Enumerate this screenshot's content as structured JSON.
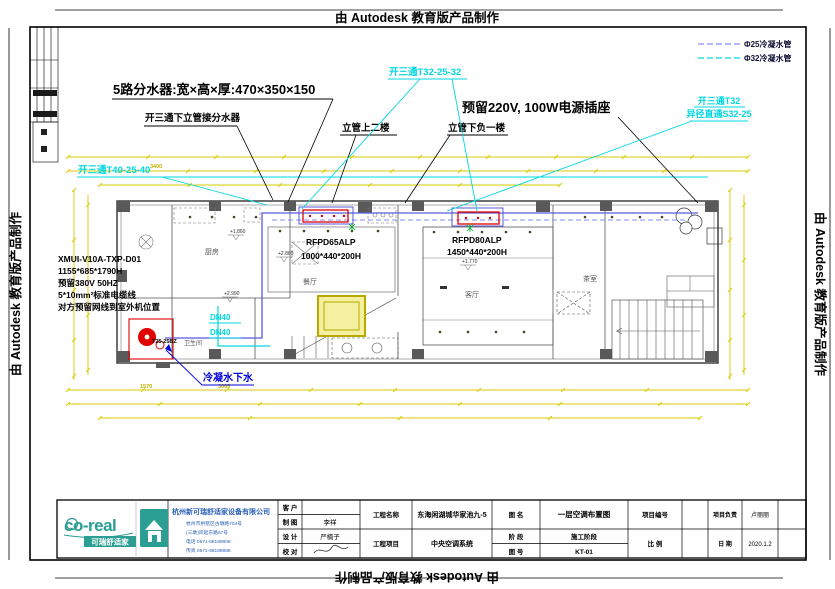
{
  "watermark": {
    "text": "由 Autodesk 教育版产品制作"
  },
  "legend": {
    "items": [
      {
        "label": "Φ25冷凝水管",
        "color": "#8a8af5"
      },
      {
        "label": "Φ32冷凝水管",
        "color": "#00d7e0"
      }
    ]
  },
  "callouts": {
    "manifold": "5路分水器:宽×高×厚:470×350×150",
    "tee_branch": "开三通下立管接分水器",
    "riser_up": "立管上二楼",
    "riser_down": "立管下负一楼",
    "power_socket": "预留220V, 100W电源插座",
    "tee_t32": "开三通T32-25-32",
    "tee_t32_right_line1": "开三通T32",
    "tee_t32_right_line2": "异径直通S32-25",
    "tee_t40": "开三通T40-25-40",
    "condensate_drain": "冷凝水下水",
    "dn40_a": "DN40",
    "dn40_b": "DN40",
    "pipe_tag": "T25-25BZ"
  },
  "outdoor_unit_note": {
    "lines": [
      "XMUI-V10A-TXP-D01",
      "1155*685*1790H",
      "预留380V 50HZ",
      "5*10mm²标准电缆线",
      "对方预留网线到室外机位置"
    ]
  },
  "indoor_units": {
    "unit1": {
      "model": "RFPD65ALP",
      "size": "1000*440*200H"
    },
    "unit2": {
      "model": "RFPD80ALP",
      "size": "1450*440*200H"
    }
  },
  "rooms": {
    "kitchen": "厨房",
    "dining": "餐厅",
    "living": "客厅",
    "tea": "茶室",
    "bath": "卫生间"
  },
  "levels": {
    "e1": "+1.860",
    "e2": "+2.860",
    "e3": "+1.770",
    "e4": "+2.990"
  },
  "dimensions": {
    "top_1": "3400",
    "bottom_1": "1570",
    "bottom_2": "3065"
  },
  "titleblock": {
    "logo_text": "co-real",
    "logo_sub": "可瑞舒适家",
    "company": "杭州新可瑞舒适家设备有限公司",
    "company_lines": [
      "杭州市拱墅区古墩路704号",
      "(三墩)风起东路67号",
      "电话 0571-88188808",
      "传真 0571-88188888"
    ],
    "fields": {
      "client_label": "客 户",
      "draft_label": "制 图",
      "draft_value": "李祥",
      "design_label": "设 计",
      "design_value": "严楠子",
      "check_label": "校 对",
      "project_name_label": "工程名称",
      "project_name_value": "东海闲湖城华家池九-5",
      "project_item_label": "工程项目",
      "project_item_value": "中央空调系统",
      "drawing_name_label": "图 名",
      "drawing_name_value": "一层空调布置图",
      "stage_label": "阶 段",
      "stage_value": "施工阶段",
      "drawing_no_label": "图 号",
      "drawing_no_value": "KT-01",
      "project_no_label": "项目编号",
      "scale_label": "比 例",
      "lead_label": "项目负责",
      "lead_value": "卢丽丽",
      "date_label": "日 期",
      "date_value": "2020.1.2"
    }
  }
}
